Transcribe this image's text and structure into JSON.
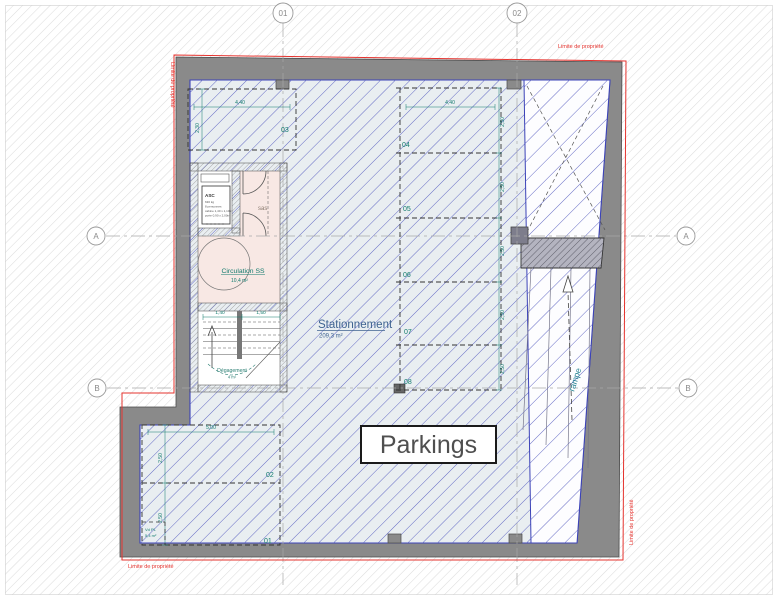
{
  "drawing": {
    "grid": {
      "col1": "01",
      "col2": "02",
      "rowA": "A",
      "rowB": "B"
    },
    "labels": {
      "stationnement": "Stationnement",
      "stationnement_area": "209,3 m²",
      "parkings": "Parkings",
      "rampe": "rampe",
      "circulation": "Circulation SS",
      "circulation_area": "10,4 m²",
      "degagement": "Dégagement",
      "degagement_area": "4 m²",
      "sas": "sas",
      "asc_title": "ASC",
      "asc_line1": "630 kg",
      "asc_line2": "8 personnes",
      "asc_line3": "cabine 1,40 x 1,10m",
      "asc_line4": "porte 0,90 x 2,00m",
      "corner_label": "Vd PL",
      "corner_area": "5,4 m²",
      "limite": "Limite de propriété"
    },
    "spaces": {
      "numbers": [
        "01",
        "02",
        "03",
        "04",
        "05",
        "06",
        "07",
        "08"
      ]
    },
    "dims": {
      "d440": "4,40",
      "d230": "2,30",
      "d250": "2,50",
      "d500": "5,00",
      "d140": "1,40",
      "d150": "1,50"
    },
    "colors": {
      "wall": "#8a8a8a",
      "interior_tint": "#e9eef1",
      "hatch_blue": "#565cc0",
      "hatch_bg": "#dcdcdc",
      "teal": "#117a6d",
      "steel_blue": "#3f6391",
      "red": "#e5332e",
      "parkings_text": "#4f4f4f"
    }
  }
}
